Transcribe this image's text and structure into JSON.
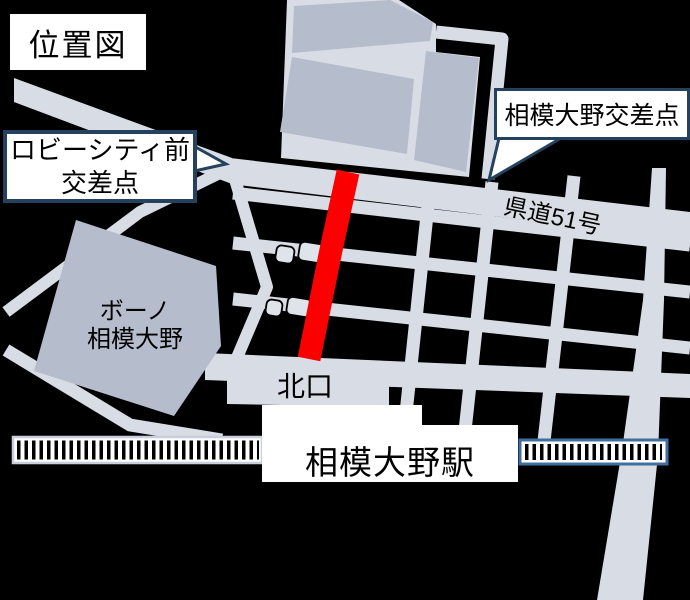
{
  "title": "位置図",
  "callouts": {
    "lobby_city": {
      "line1": "ロビーシティ前",
      "line2": "交差点"
    },
    "sagami_ono": {
      "label": "相模大野交差点"
    }
  },
  "labels": {
    "route": "県道51号",
    "bono_line1": "ボーノ",
    "bono_line2": "相模大野",
    "north_exit": "北口",
    "station": "相模大野駅"
  },
  "colors": {
    "background": "#000000",
    "road": "#d8dce5",
    "building": "#b5bccb",
    "highlight_route": "#fa0000",
    "callout_border": "#24425e",
    "railway_border_left": "#c9cedb",
    "railway_border_right": "#3f6f9f",
    "railway_tie": "#000000",
    "box_background": "#ffffff",
    "text": "#000000"
  }
}
